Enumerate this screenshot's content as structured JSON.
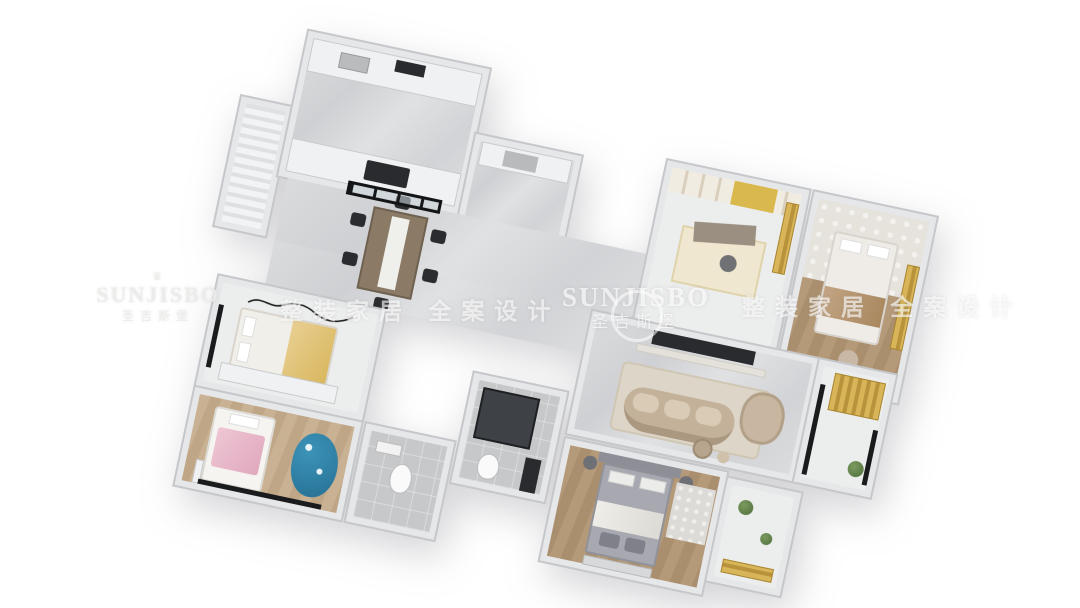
{
  "watermark": {
    "brand_latin": "SUNJISBO",
    "brand_cn": "圣吉斯堡",
    "slogan": "整装家居 全案设计",
    "ornament": "♛",
    "color": "#ffffff"
  },
  "scene": {
    "type": "3d-apartment-floorplan-render",
    "background": "#ffffff",
    "plan_rotation_deg": 12,
    "rooms": [
      {
        "name": "laundry-balcony"
      },
      {
        "name": "kitchen"
      },
      {
        "name": "entry-hall"
      },
      {
        "name": "dining-area"
      },
      {
        "name": "study"
      },
      {
        "name": "bedroom-right"
      },
      {
        "name": "bedroom-left"
      },
      {
        "name": "kids-bedroom"
      },
      {
        "name": "bathroom-small"
      },
      {
        "name": "bathroom-shower"
      },
      {
        "name": "master-bedroom"
      },
      {
        "name": "master-balcony"
      },
      {
        "name": "living-room"
      },
      {
        "name": "living-balcony"
      }
    ],
    "colors": {
      "wall": "#e6e7e9",
      "wall_edge": "#c6c7ca",
      "marble_floor": "#d6d7d9",
      "wood_floor": "#b29877",
      "accent_gold": "#d4ae4f",
      "accent_pink": "#e7b9ca",
      "accent_blue": "#2f7fa3",
      "sofa_beige": "#c3b19a",
      "bed_gray": "#a7a8b0",
      "dark_fixture": "#1d1e20"
    }
  }
}
